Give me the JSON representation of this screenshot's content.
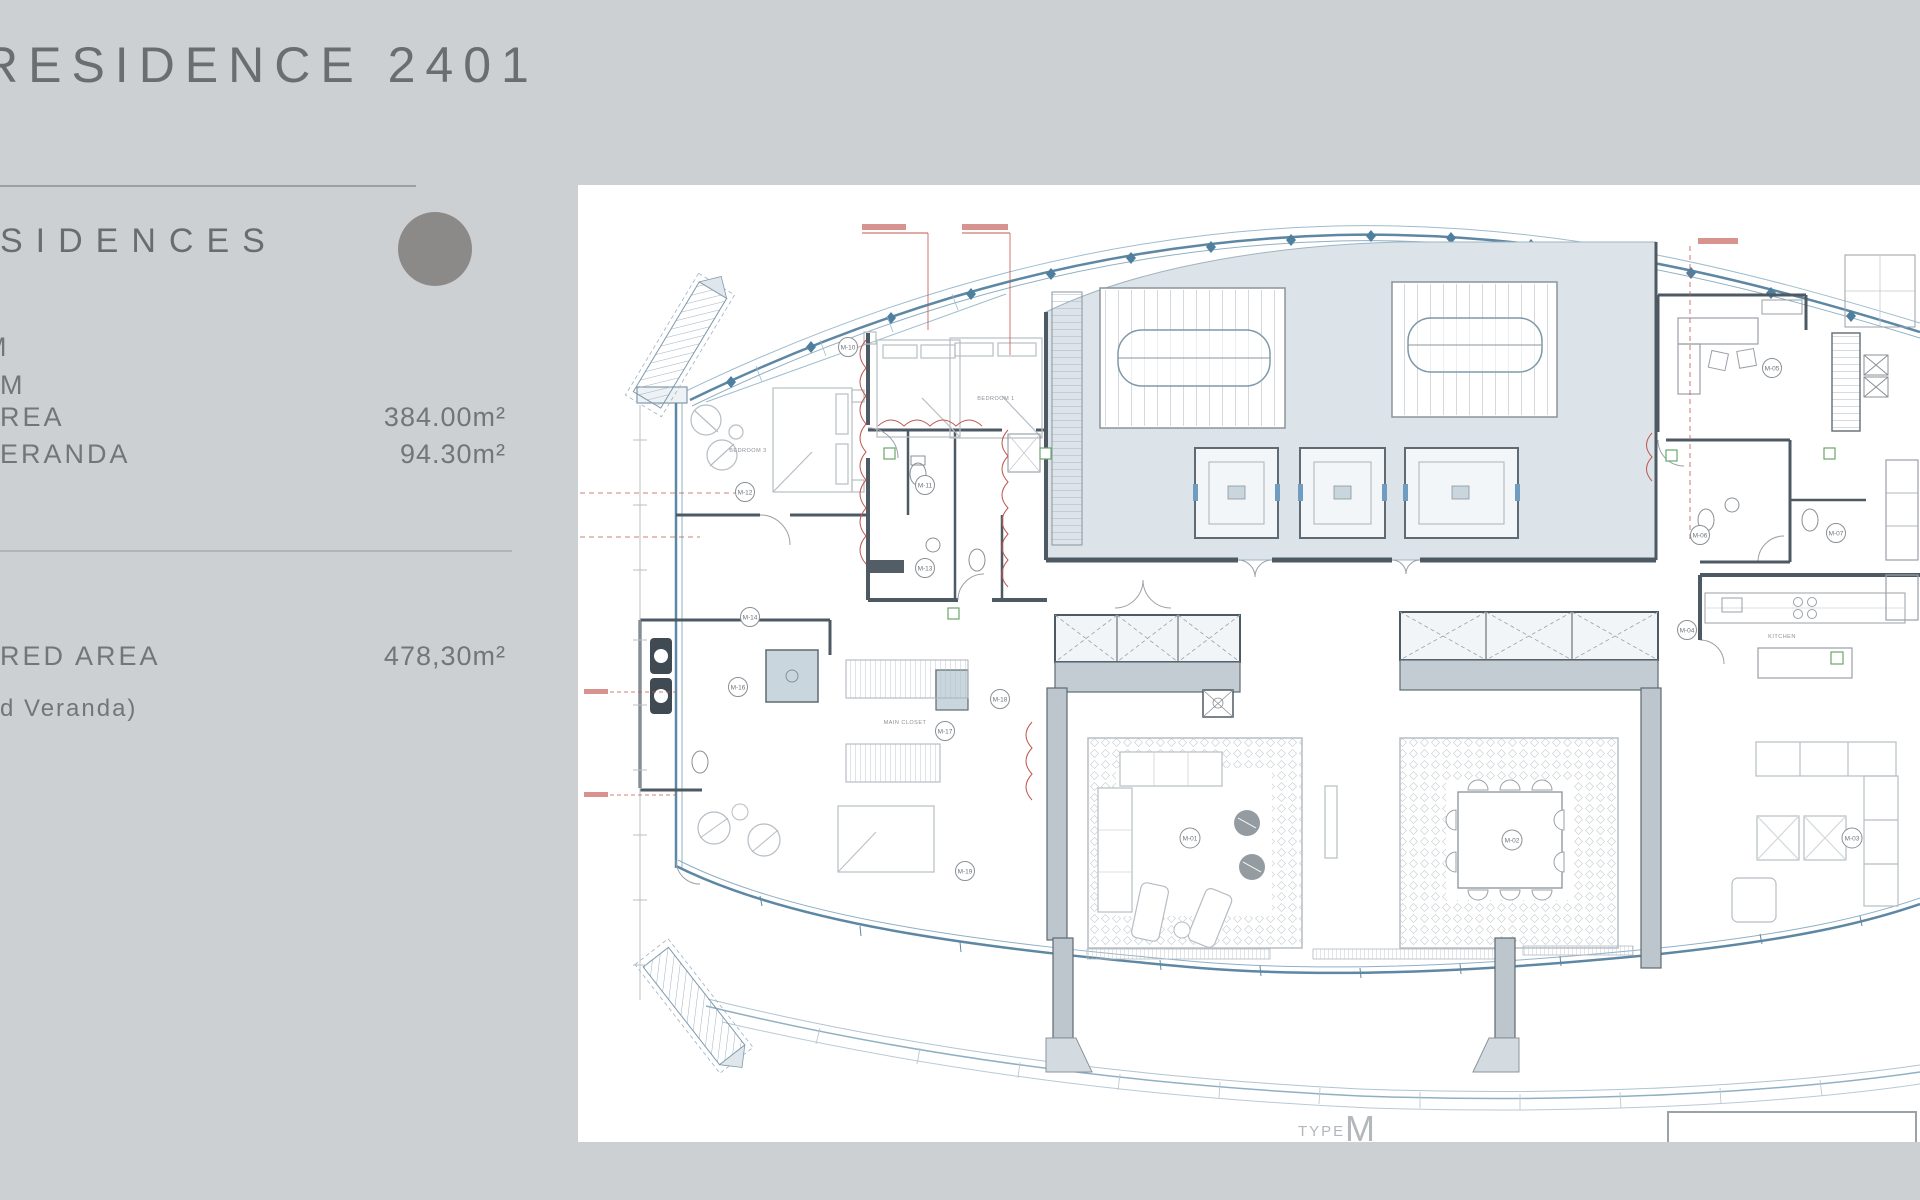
{
  "sidebar": {
    "title": "RESIDENCE 2401",
    "heading_fragment": "SIDENCES",
    "rows": [
      {
        "label": "M",
        "value": ""
      },
      {
        "label": "M",
        "value": ""
      },
      {
        "label": "REA",
        "value": "384.00m²"
      },
      {
        "label": "ERANDA",
        "value": "94.30m²"
      },
      {
        "label": "RED AREA",
        "value": "478,30m²"
      },
      {
        "label": "d Veranda)",
        "value": ""
      }
    ]
  },
  "plan": {
    "type_label": {
      "prefix": "TYPE",
      "letter": "M"
    },
    "room_labels": {
      "bedroom3": "BEDROOM 3",
      "bedroom1": "BEDROOM 1",
      "main_closet": "MAIN CLOSET",
      "kitchen": "KITCHEN"
    },
    "m_markers": [
      {
        "code": "M-10"
      },
      {
        "code": "M-12"
      },
      {
        "code": "M-11"
      },
      {
        "code": "M-13"
      },
      {
        "code": "M-14"
      },
      {
        "code": "M-16"
      },
      {
        "code": "M-17"
      },
      {
        "code": "M-18"
      },
      {
        "code": "M-19"
      },
      {
        "code": "M-01"
      },
      {
        "code": "M-02"
      },
      {
        "code": "M-03"
      },
      {
        "code": "M-04"
      },
      {
        "code": "M-05"
      },
      {
        "code": "M-06"
      },
      {
        "code": "M-07"
      }
    ],
    "colors": {
      "page_bg": "#cdd0d3",
      "panel_text": "#6e7378",
      "circle": "#8b8a88",
      "hull_blue": "#5d87a3",
      "hull_blue_light": "#8fb0c3",
      "wall_dark": "#4e5a63",
      "core_fill": "#dce4e9",
      "annotation_red": "#c0564f",
      "accent_green": "#69a86a",
      "type_label": "#b2b7bc"
    }
  }
}
